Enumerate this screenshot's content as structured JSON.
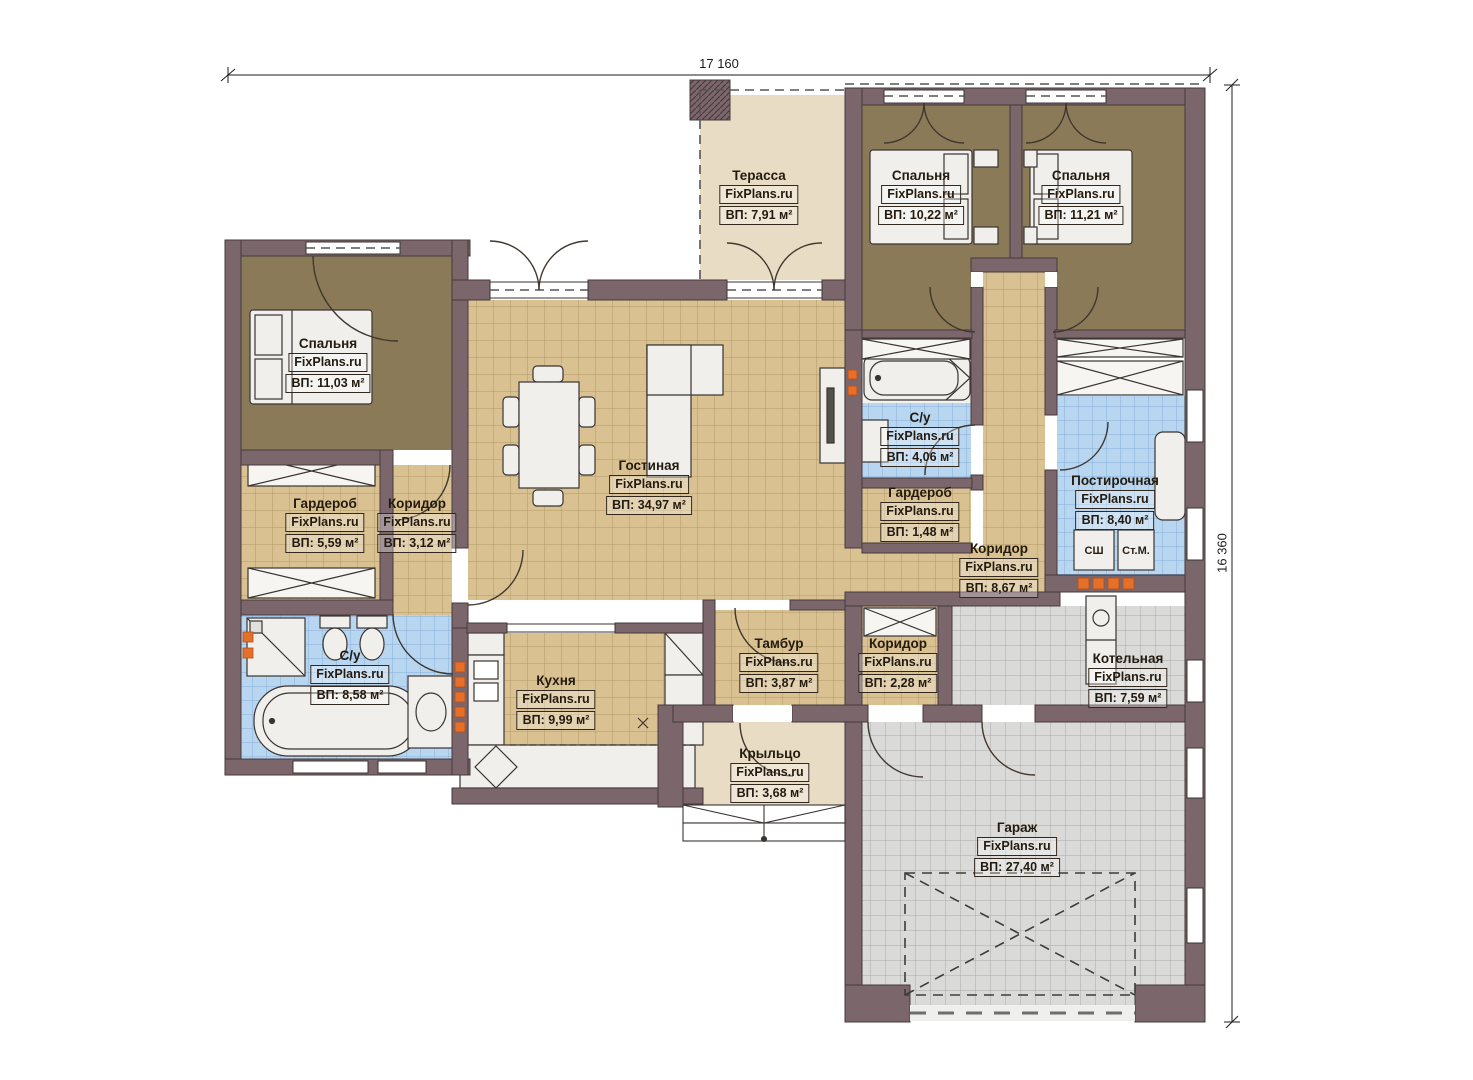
{
  "watermark": "FixPlans.ru",
  "dimensions": {
    "width_label": "17 160",
    "height_label": "16 360"
  },
  "rooms": [
    {
      "id": "terrace",
      "name": "Терасса",
      "area": "ВП: 7,91 м²"
    },
    {
      "id": "bedroom-1",
      "name": "Спальня",
      "area": "ВП: 10,22 м²"
    },
    {
      "id": "bedroom-2",
      "name": "Спальня",
      "area": "ВП: 11,21 м²"
    },
    {
      "id": "bedroom-3",
      "name": "Спальня",
      "area": "ВП: 11,03 м²"
    },
    {
      "id": "living-room",
      "name": "Гостиная",
      "area": "ВП: 34,97 м²"
    },
    {
      "id": "bathroom-small",
      "name": "С/у",
      "area": "ВП: 4,06 м²"
    },
    {
      "id": "wardrobe-left",
      "name": "Гардероб",
      "area": "ВП: 5,59 м²"
    },
    {
      "id": "corridor-left",
      "name": "Коридор",
      "area": "ВП: 3,12 м²"
    },
    {
      "id": "wardrobe-small",
      "name": "Гардероб",
      "area": "ВП: 1,48 м²"
    },
    {
      "id": "corridor-main",
      "name": "Коридор",
      "area": "ВП: 8,67 м²"
    },
    {
      "id": "laundry",
      "name": "Постирочная",
      "area": "ВП: 8,40 м²"
    },
    {
      "id": "bathroom-big",
      "name": "С/у",
      "area": "ВП: 8,58 м²"
    },
    {
      "id": "kitchen",
      "name": "Кухня",
      "area": "ВП: 9,99 м²"
    },
    {
      "id": "vestibule",
      "name": "Тамбур",
      "area": "ВП: 3,87 м²"
    },
    {
      "id": "corridor-small",
      "name": "Коридор",
      "area": "ВП: 2,28 м²"
    },
    {
      "id": "boiler-room",
      "name": "Котельная",
      "area": "ВП: 7,59 м²"
    },
    {
      "id": "porch",
      "name": "Крыльцо",
      "area": "ВП: 3,68 м²"
    },
    {
      "id": "garage",
      "name": "Гараж",
      "area": "ВП: 27,40 м²"
    }
  ],
  "appliances": {
    "drying_cabinet": "СШ",
    "washing_machine": "Ст.М."
  },
  "colors": {
    "wall": "#7b666b",
    "wall_outline": "#453a3e",
    "bedroom_floor": "#8b7a57",
    "tile_floor": "#d9c192",
    "wet_floor": "#b9d6f0",
    "garage_floor": "#dadad8",
    "terrace_floor": "#e8dcc4",
    "radiator_accent": "#e4702a",
    "furniture": "#f0efec"
  }
}
